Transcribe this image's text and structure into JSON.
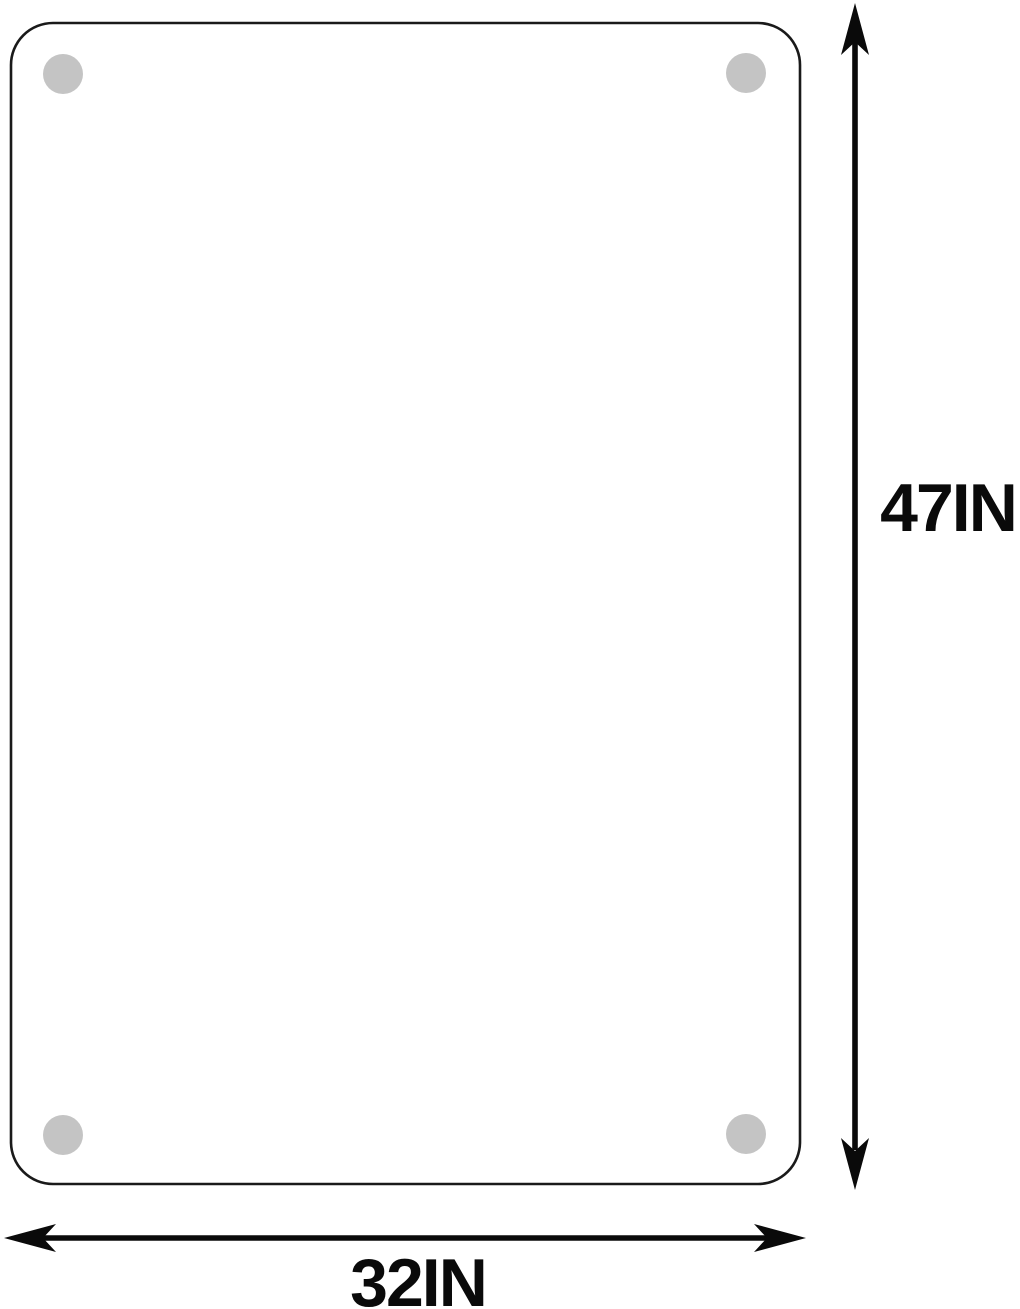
{
  "diagram": {
    "dimensions": {
      "height_label": "47IN",
      "width_label": "32IN"
    },
    "icons": {
      "height_arrow": "double-headed-arrow-vertical",
      "width_arrow": "double-headed-arrow-horizontal",
      "hole": "mounting-hole-dot"
    },
    "colors": {
      "outline": "#1a1a1a",
      "arrow": "#0a0a0a",
      "label": "#0a0a0a",
      "hole_fill": "#c4c4c4",
      "background": "#ffffff"
    }
  }
}
